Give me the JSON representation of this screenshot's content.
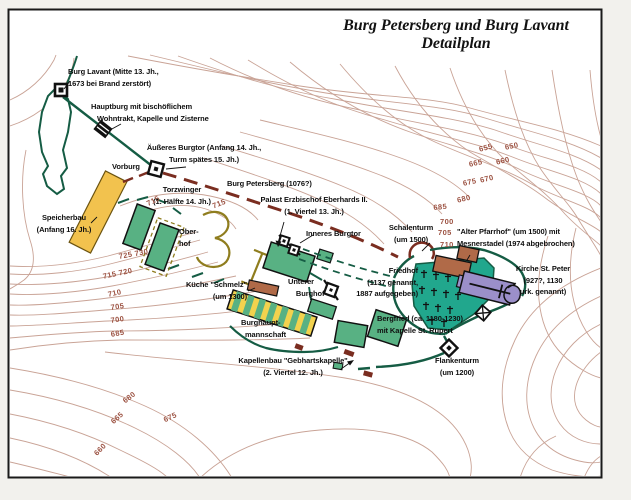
{
  "title": {
    "line1": "Burg Petersberg und Burg Lavant",
    "line2": "Detailplan"
  },
  "colors": {
    "wall_green": "#155c44",
    "building_green": "#58b183",
    "cemetery_teal": "#21a78d",
    "church_purple": "#9b8fc9",
    "building_brown": "#b06a48",
    "storage_yellow": "#f2c24e",
    "ruin_khaki": "#8f7d1e",
    "path_brown": "#7a2d20",
    "contour_brown": "#c9a396",
    "contour_label": "#9c5242",
    "label_black": "#111111"
  },
  "map": {
    "labels": [
      {
        "name": "burg-lavant",
        "x": 68,
        "y": 66,
        "align": "left",
        "lines": [
          "Burg Lavant (Mitte 13. Jh.,",
          "1673 bei Brand zerstört)"
        ]
      },
      {
        "name": "hauptburg",
        "x": 91,
        "y": 101,
        "align": "left",
        "lines": [
          "Hauptburg mit bischöflichem",
          "   Wohntrakt, Kapelle und Zisterne"
        ]
      },
      {
        "name": "aeusseres-burgtor",
        "x": 204,
        "y": 142,
        "align": "center",
        "lines": [
          "Äußeres Burgtor (Anfang 14. Jh.,",
          "Turm spätes 15. Jh.)"
        ]
      },
      {
        "name": "vorburg",
        "x": 112,
        "y": 161,
        "align": "left",
        "lines": [
          "Vorburg"
        ]
      },
      {
        "name": "torzwinger",
        "x": 182,
        "y": 184,
        "align": "center",
        "lines": [
          "Torzwinger",
          "(1. Hälfte 14. Jh.)"
        ]
      },
      {
        "name": "burg-petersberg",
        "x": 227,
        "y": 178,
        "align": "left",
        "lines": [
          "Burg Petersberg (1076?)"
        ]
      },
      {
        "name": "palast",
        "x": 314,
        "y": 194,
        "align": "center",
        "lines": [
          "Palast Erzbischof Eberhards II.",
          "(1. Viertel 13. Jh.)"
        ]
      },
      {
        "name": "inneres-burgtor",
        "x": 306,
        "y": 228,
        "align": "left",
        "lines": [
          "Inneres Burgtor"
        ]
      },
      {
        "name": "schalenturm",
        "x": 411,
        "y": 222,
        "align": "center",
        "lines": [
          "Schalenturm",
          "(um 1500)"
        ]
      },
      {
        "name": "alter-pfarrhof",
        "x": 457,
        "y": 226,
        "align": "left",
        "lines": [
          "\"Alter Pfarrhof\" (um 1500) mit",
          "Mesnerstadel (1974 abgebrochen)"
        ]
      },
      {
        "name": "friedhof",
        "x": 418,
        "y": 265,
        "align": "right",
        "lines": [
          "Friedhof",
          "(1137 genannt,",
          "1887 aufgegeben)"
        ]
      },
      {
        "name": "kirche-st-peter",
        "x": 543,
        "y": 263,
        "align": "center",
        "lines": [
          "Kirche St. Peter",
          "(927?, 1130",
          "urk. genannt)"
        ]
      },
      {
        "name": "kueche-schmelz",
        "x": 247,
        "y": 279,
        "align": "right",
        "lines": [
          "Küche \"Schmelz\"",
          "(um 1300)"
        ]
      },
      {
        "name": "unterer-burghof",
        "x": 288,
        "y": 276,
        "align": "left",
        "lines": [
          "Unterer",
          "    Burghof"
        ]
      },
      {
        "name": "burghauptmannschaft",
        "x": 241,
        "y": 317,
        "align": "left",
        "lines": [
          "Burghaupt-",
          "  mannschaft"
        ]
      },
      {
        "name": "bergfried",
        "x": 377,
        "y": 313,
        "align": "left",
        "lines": [
          "Bergfried (ca. 1180-1230)",
          "mit Kapelle St. Rupert"
        ]
      },
      {
        "name": "kapellenbau",
        "x": 293,
        "y": 355,
        "align": "center",
        "lines": [
          "Kapellenbau \"Gebhartskapelle\"",
          "(2. Viertel 12. Jh.)"
        ]
      },
      {
        "name": "flankenturm",
        "x": 457,
        "y": 355,
        "align": "center",
        "lines": [
          "Flankenturm",
          "(um 1200)"
        ]
      },
      {
        "name": "speicherbau",
        "x": 64,
        "y": 212,
        "align": "center",
        "lines": [
          "Speicherbau",
          "(Anfang 16. Jh.)"
        ]
      },
      {
        "name": "oberhof",
        "x": 179,
        "y": 226,
        "align": "left",
        "lines": [
          "Ober-",
          "hof"
        ]
      }
    ],
    "contour_labels": [
      {
        "text": "715",
        "x": 145,
        "y": 200,
        "rot": -28
      },
      {
        "text": "715",
        "x": 211,
        "y": 202,
        "rot": -22
      },
      {
        "text": "725 730",
        "x": 118,
        "y": 252,
        "rot": -10
      },
      {
        "text": "715 720",
        "x": 102,
        "y": 272,
        "rot": -12
      },
      {
        "text": "710",
        "x": 107,
        "y": 290,
        "rot": -12
      },
      {
        "text": "705",
        "x": 110,
        "y": 303,
        "rot": -8
      },
      {
        "text": "700",
        "x": 110,
        "y": 316,
        "rot": -8
      },
      {
        "text": "685",
        "x": 110,
        "y": 330,
        "rot": -10
      },
      {
        "text": "680",
        "x": 121,
        "y": 398,
        "rot": -38
      },
      {
        "text": "665",
        "x": 109,
        "y": 419,
        "rot": -42
      },
      {
        "text": "675",
        "x": 162,
        "y": 416,
        "rot": -25
      },
      {
        "text": "660",
        "x": 92,
        "y": 451,
        "rot": -45
      },
      {
        "text": "655",
        "x": 478,
        "y": 145,
        "rot": -15
      },
      {
        "text": "650",
        "x": 504,
        "y": 143,
        "rot": -12
      },
      {
        "text": "665",
        "x": 468,
        "y": 160,
        "rot": -12
      },
      {
        "text": "660",
        "x": 495,
        "y": 158,
        "rot": -14
      },
      {
        "text": "675",
        "x": 462,
        "y": 179,
        "rot": -12
      },
      {
        "text": "670",
        "x": 479,
        "y": 176,
        "rot": -14
      },
      {
        "text": "685",
        "x": 433,
        "y": 203,
        "rot": -5
      },
      {
        "text": "680",
        "x": 456,
        "y": 196,
        "rot": -14
      },
      {
        "text": "700",
        "x": 440,
        "y": 217,
        "rot": 0
      },
      {
        "text": "705",
        "x": 438,
        "y": 228,
        "rot": 0
      },
      {
        "text": "710",
        "x": 440,
        "y": 240,
        "rot": 0
      }
    ]
  }
}
